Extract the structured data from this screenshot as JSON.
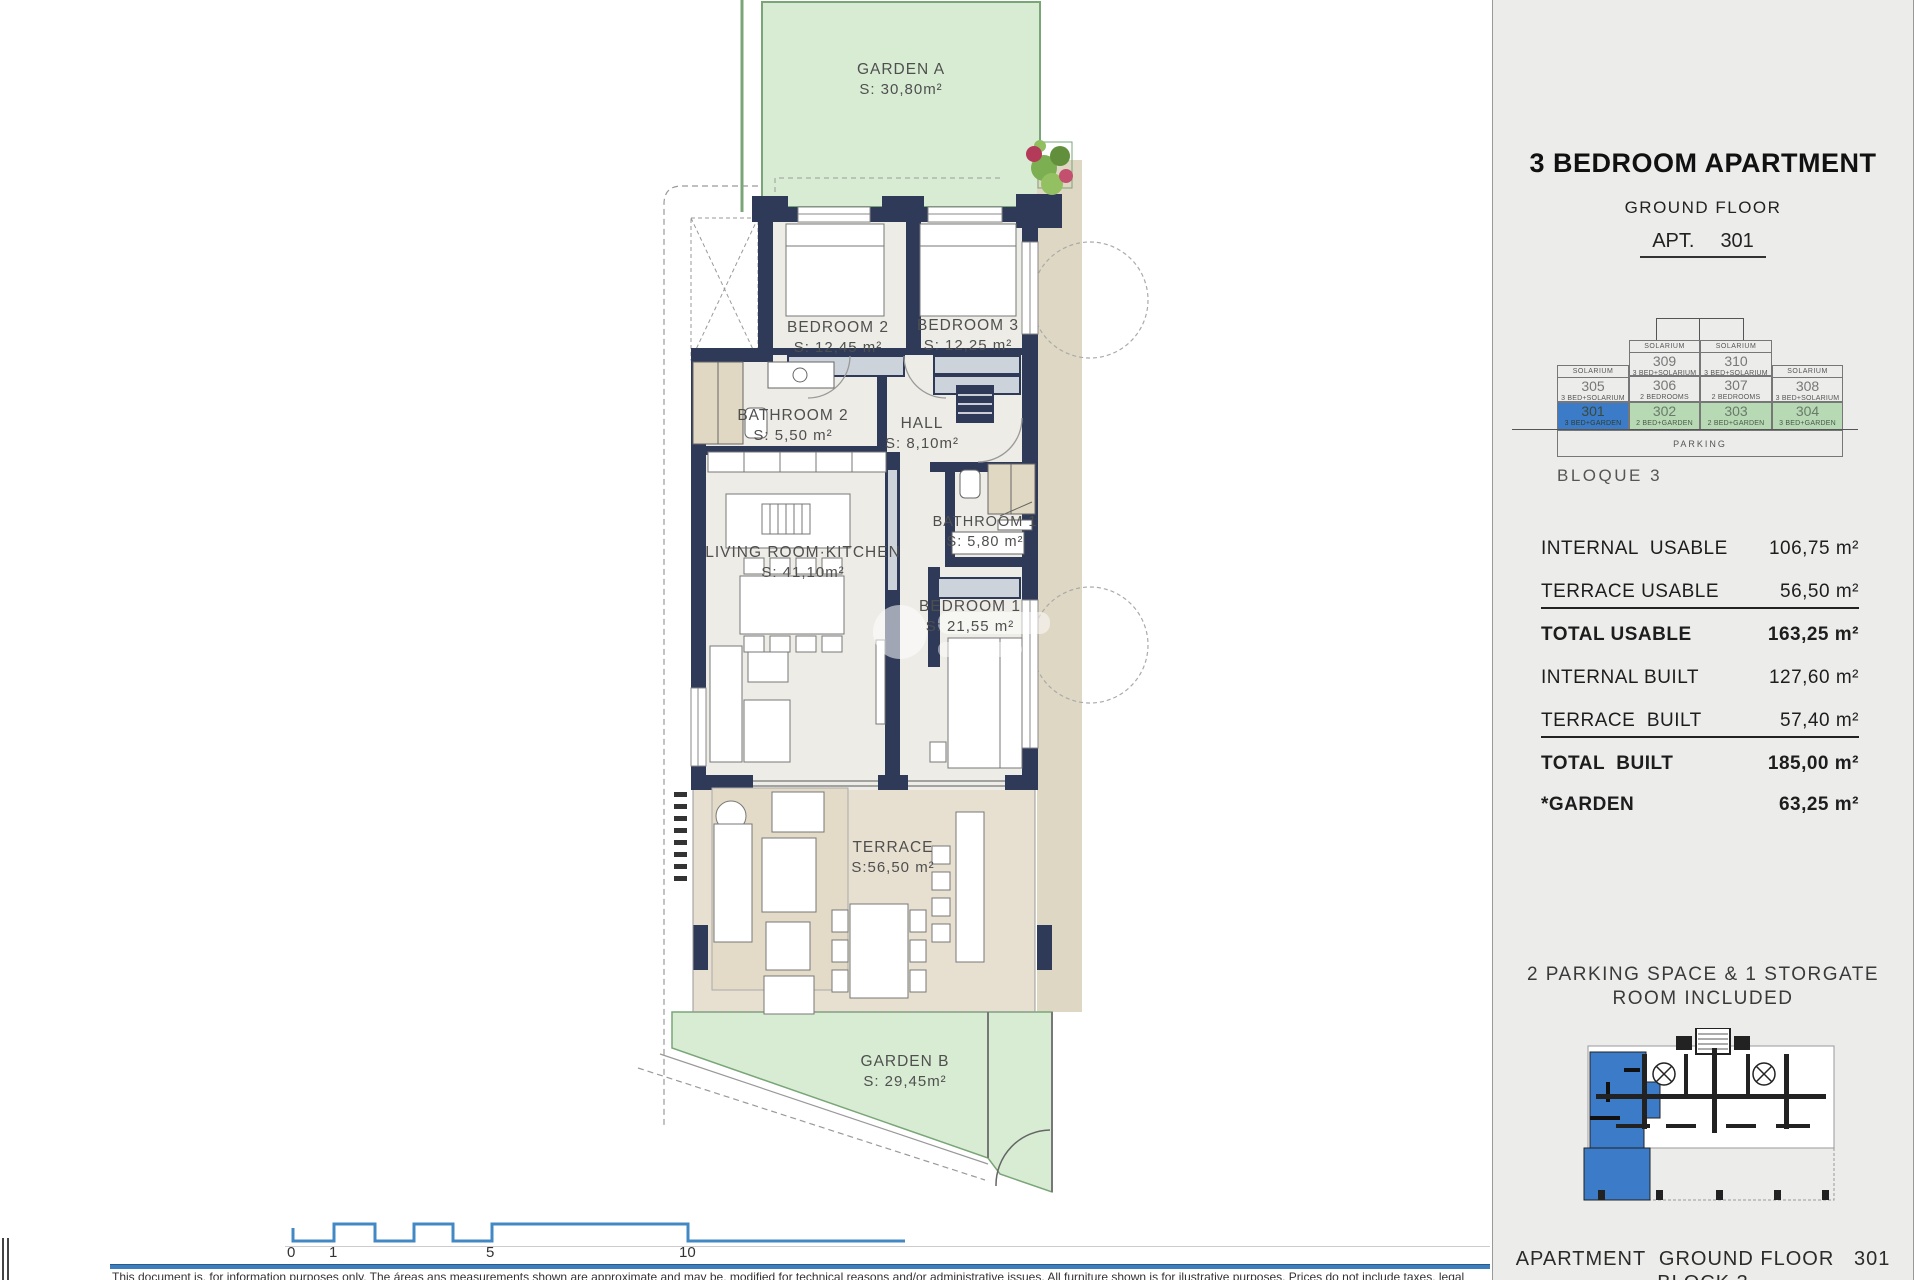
{
  "plan": {
    "garden_a": {
      "name": "GARDEN A",
      "area": "S: 30,80m²"
    },
    "bedroom2": {
      "name": "BEDROOM 2",
      "area": "S: 12,45 m²"
    },
    "bedroom3": {
      "name": "BEDROOM 3",
      "area": "S: 12,25 m²"
    },
    "bathroom2": {
      "name": "BATHROOM 2",
      "area": "S: 5,50 m²"
    },
    "hall": {
      "name": "HALL",
      "area": "S: 8,10m²"
    },
    "bathroom1": {
      "name": "BATHROOM 1",
      "area": "S: 5,80 m²"
    },
    "living": {
      "name": "LIVING ROOM·KITCHEN",
      "area": "S: 41,10m²"
    },
    "bedroom1": {
      "name": "BEDROOM 1",
      "area": "S: 21,55 m²"
    },
    "terrace": {
      "name": "TERRACE",
      "area": "S:56,50 m²"
    },
    "garden_b": {
      "name": "GARDEN B",
      "area": "S: 29,45m²"
    },
    "scale": {
      "t0": "0",
      "t1": "1",
      "t5": "5",
      "t10": "10"
    }
  },
  "panel": {
    "title": "3 BEDROOM APARTMENT",
    "floor": "GROUND FLOOR",
    "apt_label": "APT.",
    "apt_number": "301",
    "stack": {
      "u": [
        {
          "header": "SOLARIUM",
          "number": "309",
          "label": "3 BED+SOLARIUM"
        },
        {
          "header": "SOLARIUM",
          "number": "310",
          "label": "3 BED+SOLARIUM"
        }
      ],
      "m": [
        {
          "header": "SOLARIUM",
          "number": "305",
          "label": "3 BED+SOLARIUM"
        },
        {
          "number": "306",
          "label": "2 BEDROOMS"
        },
        {
          "number": "307",
          "label": "2 BEDROOMS"
        },
        {
          "header": "SOLARIUM",
          "number": "308",
          "label": "3 BED+SOLARIUM"
        }
      ],
      "b": [
        {
          "number": "301",
          "label": "3 BED+GARDEN"
        },
        {
          "number": "302",
          "label": "2 BED+GARDEN"
        },
        {
          "number": "303",
          "label": "2 BED+GARDEN"
        },
        {
          "number": "304",
          "label": "3 BED+GARDEN"
        }
      ],
      "parking": "PARKING",
      "caption": "BLOQUE 3"
    },
    "measurements": [
      {
        "label": "INTERNAL  USABLE",
        "value": "106,75 m²"
      },
      {
        "label": "TERRACE USABLE",
        "value": "56,50 m²"
      },
      {
        "label": "TOTAL USABLE",
        "value": "163,25 m²"
      },
      {
        "label": "INTERNAL BUILT",
        "value": "127,60 m²"
      },
      {
        "label": "TERRACE  BUILT",
        "value": "57,40 m²"
      },
      {
        "label": "TOTAL  BUILT",
        "value": "185,00 m²"
      },
      {
        "label": "*GARDEN",
        "value": "63,25 m²"
      }
    ],
    "note_line1": "2 PARKING SPACE & 1 STORGATE",
    "note_line2": "ROOM INCLUDED",
    "footer_line1": "APARTMENT  GROUND FLOOR   301",
    "footer_line2": "BLOCK 3"
  },
  "footer": {
    "disclaimer": "This document is, for information purposes only. The áreas ans measurements shown are approximate and may be, modified for technical reasons and/or administrative issues. All furniture shown is for ilustrative purposes. Prices do not include taxes, legal"
  },
  "colors": {
    "wall_navy": "#2e3a58",
    "garden_green": "#d8ecd3",
    "garden_border": "#79a577",
    "terrace_beige": "#e7e0d1",
    "unit_blue": "#3c7bc7",
    "unit_green": "#b7dab4",
    "accent_blue": "#4288c5"
  }
}
